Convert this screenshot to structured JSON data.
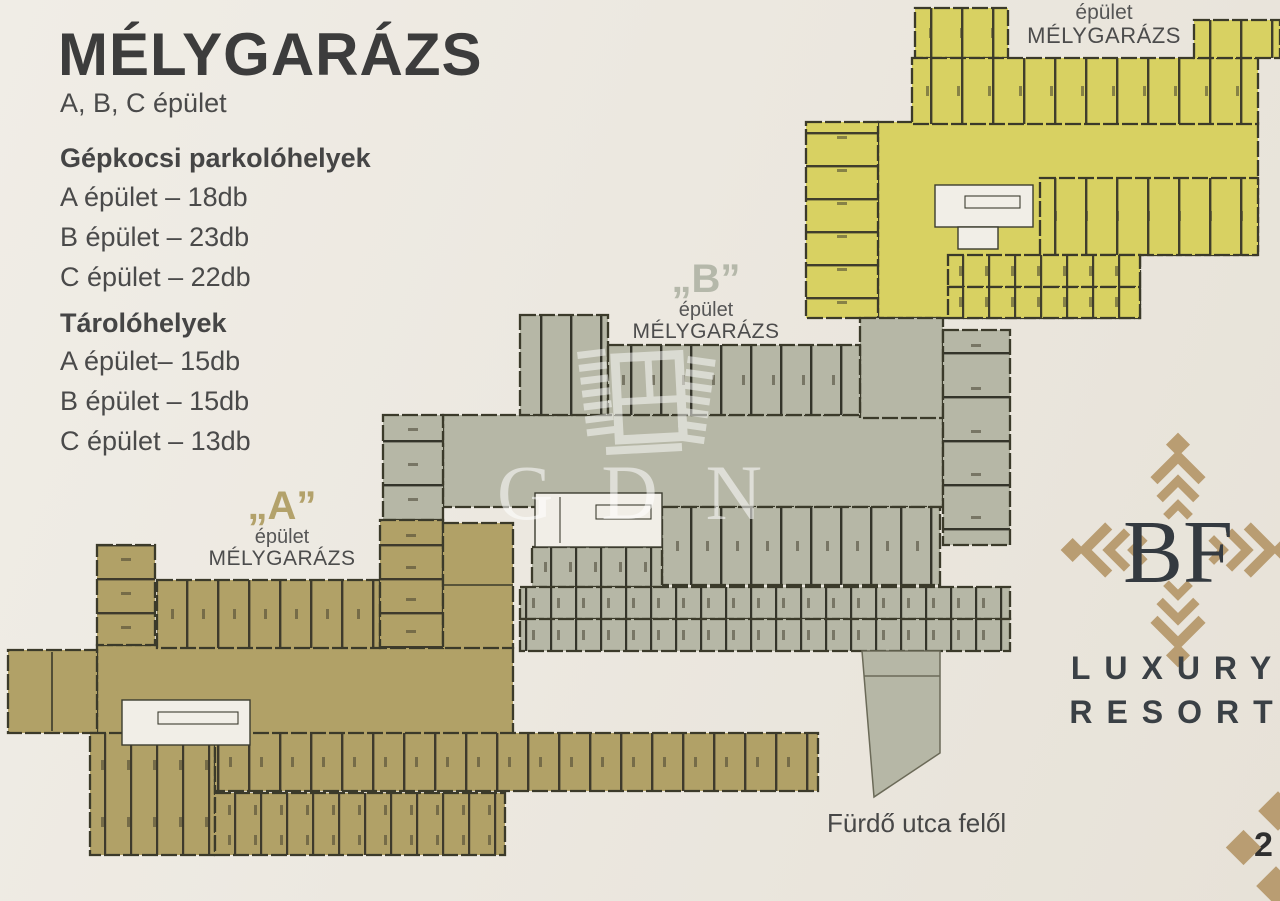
{
  "colors": {
    "background": "#ece8e0",
    "building_a": "#b1a167",
    "building_b": "#b6b7a6",
    "building_c": "#d8d162",
    "walls": "#3b3a2a",
    "accent_tan": "#b99d72",
    "text_dark": "#3d3d3d"
  },
  "info_panel": {
    "title": "MÉLYGARÁZS",
    "subtitle": "A, B, C épület",
    "parking": {
      "heading": "Gépkocsi parkolóhelyek",
      "items": [
        "A épület – 18db",
        "B épület – 23db",
        "C épület – 22db"
      ]
    },
    "storage": {
      "heading": "Tárolóhelyek",
      "items": [
        "A épület– 15db",
        "B épület – 15db",
        "C épület – 13db"
      ]
    }
  },
  "plan_labels": {
    "a": {
      "letter": "„A”",
      "line1": "épület",
      "line2": "MÉLYGARÁZS"
    },
    "b": {
      "letter": "„B”",
      "line1": "épület",
      "line2": "MÉLYGARÁZS"
    },
    "c": {
      "line1": "épület",
      "line2": "MÉLYGARÁZS"
    }
  },
  "watermark": {
    "text": "GDN"
  },
  "logo": {
    "monogram": "BF",
    "line1": "LUXURY",
    "line2": "RESORT"
  },
  "footer": {
    "street_label": "Fürdő utca felől",
    "page_number": "2"
  }
}
